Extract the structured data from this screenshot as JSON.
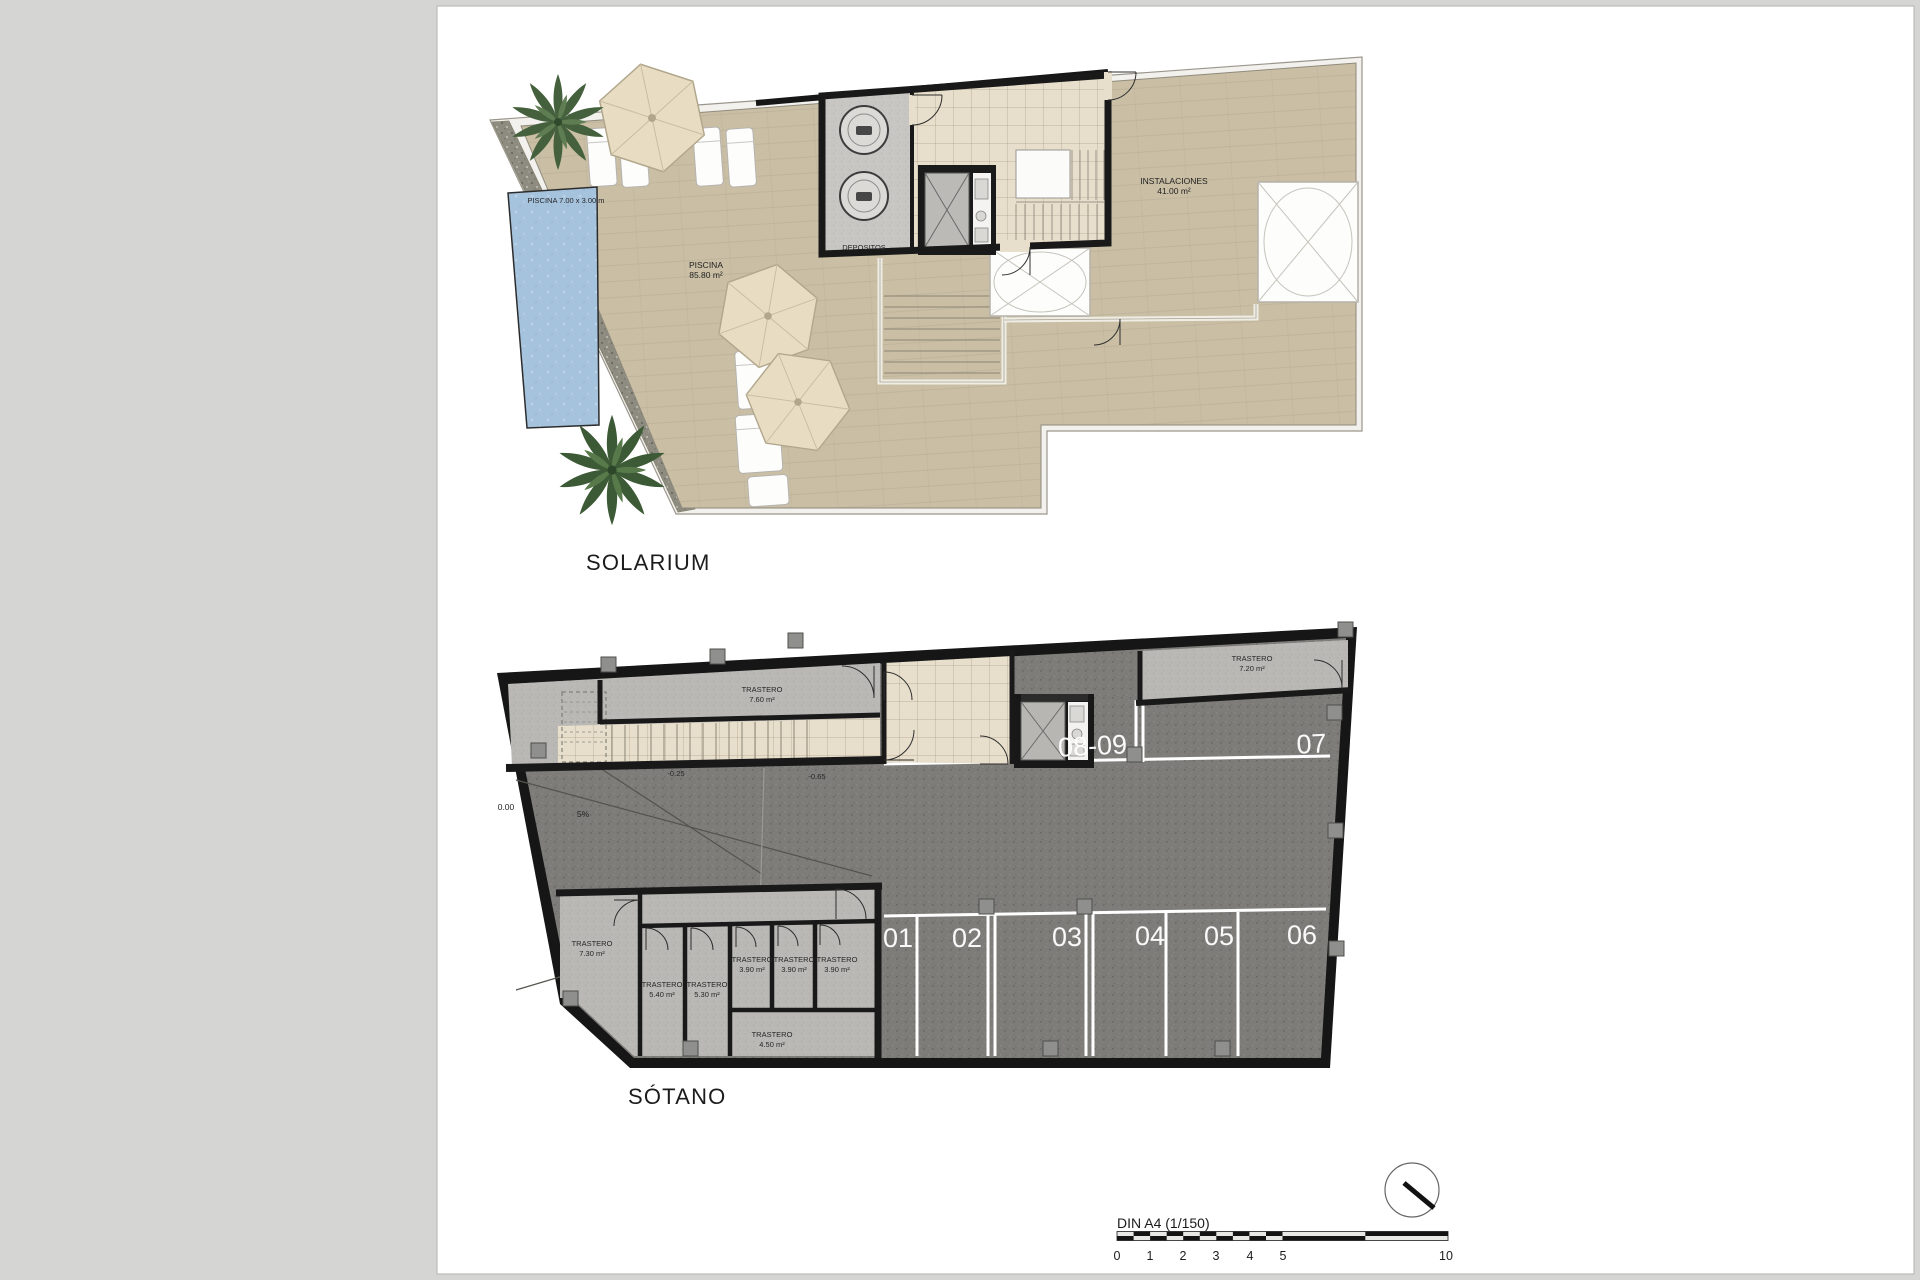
{
  "solarium": {
    "title": "SOLARIUM",
    "pool_dims": "PISCINA 7.00 x 3.00 m",
    "pool": {
      "name": "PISCINA",
      "area": "85.80 m²"
    },
    "depositos": "DEPOSITOS",
    "instalaciones": {
      "name": "INSTALACIONES",
      "area": "41.00 m²"
    }
  },
  "sotano": {
    "title": "SÓTANO",
    "levels": {
      "zero": "0.00",
      "slope": "5%",
      "upper": "-0.25",
      "lower": "-0.65"
    },
    "parking": {
      "p1": "01",
      "p2": "02",
      "p3": "03",
      "p4": "04",
      "p5": "05",
      "p6": "06",
      "p7": "07",
      "p89": "08-09"
    },
    "storage": {
      "t760": {
        "name": "TRASTERO",
        "area": "7.60 m²"
      },
      "t720": {
        "name": "TRASTERO",
        "area": "7.20 m²"
      },
      "t730": {
        "name": "TRASTERO",
        "area": "7.30 m²"
      },
      "t540": {
        "name": "TRASTERO",
        "area": "5.40 m²"
      },
      "t530": {
        "name": "TRASTERO",
        "area": "5.30 m²"
      },
      "t390a": {
        "name": "TRASTERO",
        "area": "3.90 m²"
      },
      "t390b": {
        "name": "TRASTERO",
        "area": "3.90 m²"
      },
      "t390c": {
        "name": "TRASTERO",
        "area": "3.90 m²"
      },
      "t450": {
        "name": "TRASTERO",
        "area": "4.50 m²"
      }
    }
  },
  "footer": {
    "scale_title": "DIN A4 (1/150)",
    "ticks": {
      "t0": "0",
      "t1": "1",
      "t2": "2",
      "t3": "3",
      "t4": "4",
      "t5": "5",
      "t10": "10"
    }
  },
  "colors": {
    "deck": "#cabfa5",
    "pool": "#a6c3de",
    "garage": "#7d7c79",
    "storage_floor": "#b9b8b5",
    "beige": "#e7decb",
    "wall": "#191919",
    "page": "#ffffff"
  }
}
